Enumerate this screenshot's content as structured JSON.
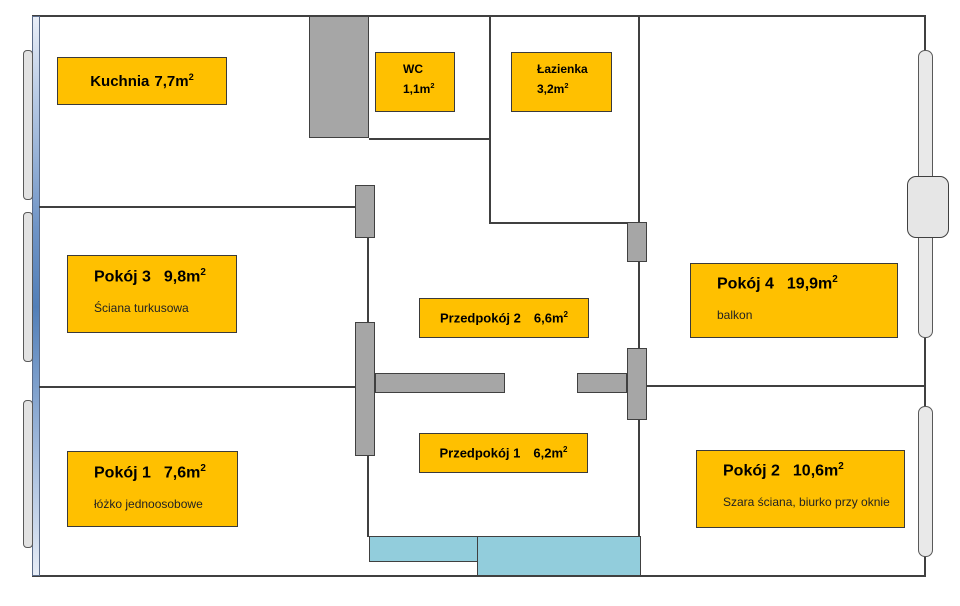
{
  "colors": {
    "label_fill": "#FFC000",
    "wall_line": "#404040",
    "wall_block": "#A6A6A6",
    "window_fill": "#E2E2E2",
    "furniture_cyan": "#92CDDC",
    "exterior_blue": "#4F81BD"
  },
  "rooms": {
    "kuchnia": {
      "name": "Kuchnia",
      "area": "7,7m",
      "sup": "2"
    },
    "wc": {
      "name": "WC",
      "area": "1,1m",
      "sup": "2"
    },
    "lazienka": {
      "name": "Łazienka",
      "area": "3,2m",
      "sup": "2"
    },
    "pokoj3": {
      "name": "Pokój 3",
      "area": "9,8m",
      "sup": "2",
      "note": "Ściana turkusowa"
    },
    "przedpokoj2": {
      "name": "Przedpokój 2",
      "area": "6,6m",
      "sup": "2"
    },
    "pokoj4": {
      "name": "Pokój 4",
      "area": "19,9m",
      "sup": "2",
      "note": "balkon"
    },
    "pokoj1": {
      "name": "Pokój 1",
      "area": "7,6m",
      "sup": "2",
      "note": "łóżko jednoosobowe"
    },
    "przedpokoj1": {
      "name": "Przedpokój 1",
      "area": "6,2m",
      "sup": "2"
    },
    "pokoj2": {
      "name": "Pokój 2",
      "area": "10,6m",
      "sup": "2",
      "note": "Szara ściana, biurko przy oknie"
    }
  }
}
